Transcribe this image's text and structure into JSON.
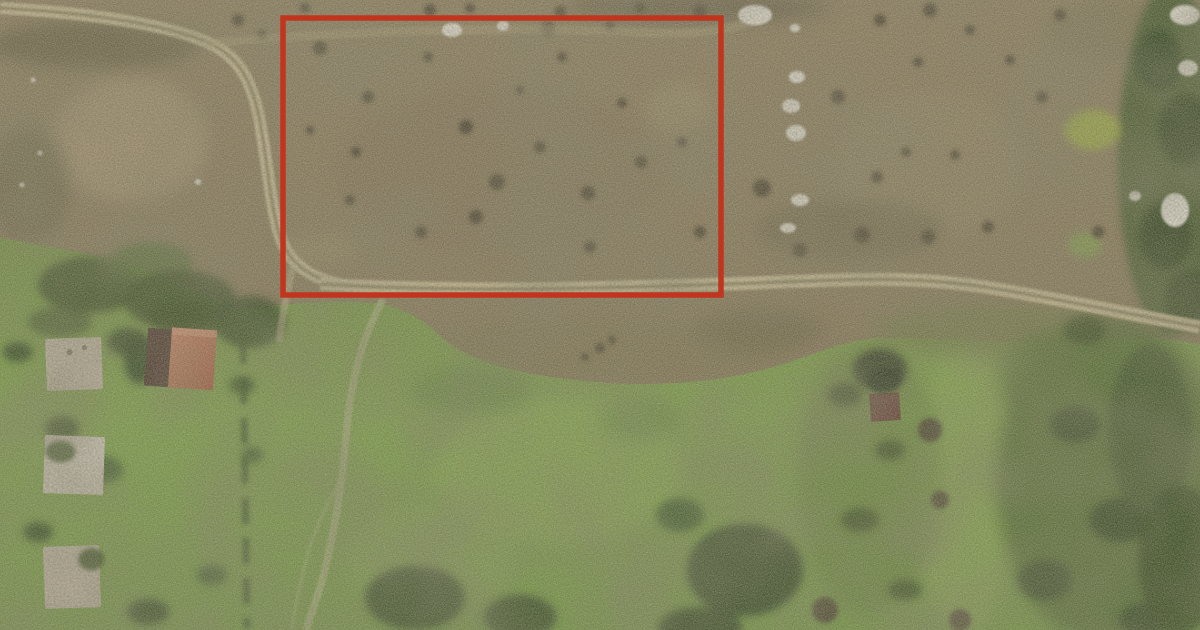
{
  "meta": {
    "kind": "aerial-satellite-photograph",
    "subject": "Aerial view of a vacant scrubland parcel outlined with a red rectangle, bordered by dirt tracks, a bright grass field below, small houses with gray and terracotta roofs on the left, scattered debris piles and tree clusters on the right"
  },
  "canvas": {
    "width": 1200,
    "height": 630
  },
  "annotation": {
    "name": "parcel-boundary",
    "shape": "rectangle",
    "x": 283,
    "y": 18,
    "width": 438,
    "height": 277,
    "stroke_width": 5.5
  },
  "palette": {
    "annotation_red": "#c1351f",
    "scrub": "#8a7b5e",
    "scrub_dark": "#60573d",
    "scrub_light": "#a79770",
    "field_green": "#7a9a4c",
    "field_light": "#8cab57",
    "shadow_green": "#2c4120",
    "tree_green": "#44602c",
    "road_tan": "#cdbf99",
    "road_center": "#837a58",
    "debris_white": "#ebe8e0",
    "roof_terracotta": "#bc6f4f",
    "roof_red_dark": "#47332c",
    "roof_gray": "#bcb4a3",
    "shed_red": "#633c34"
  },
  "features": [
    "scrubland-upper-region",
    "grass-field-lower-region",
    "dirt-road-network",
    "parcel-boundary-rectangle",
    "gray-roof-houses",
    "terracotta-roof-house",
    "dark-red-shed",
    "tree-clusters",
    "debris-piles"
  ]
}
